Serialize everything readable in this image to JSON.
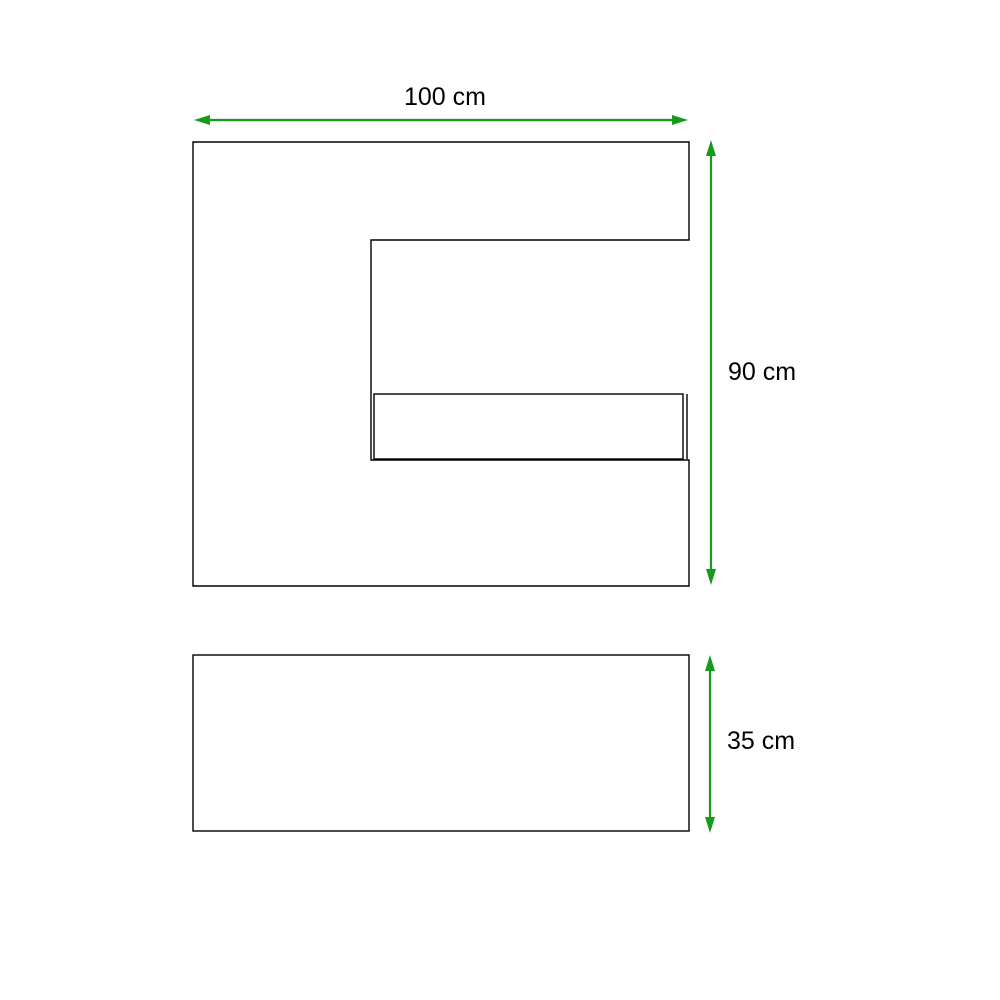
{
  "diagram": {
    "kind": "furniture-dimension-drawing",
    "unit": "cm",
    "dimensions": {
      "width": {
        "label": "100 cm",
        "value": 100,
        "orientation": "horizontal",
        "applies_to": "cabinet-front-panel"
      },
      "height": {
        "label": "90 cm",
        "value": 90,
        "orientation": "vertical",
        "applies_to": "cabinet-front-panel"
      },
      "base_height": {
        "label": "35 cm",
        "value": 35,
        "orientation": "vertical",
        "applies_to": "base-panel"
      }
    },
    "icons": {
      "dimension_arrow": "double-headed-arrow"
    },
    "colors": {
      "arrow": "#189a1a",
      "outline": "#000000",
      "text": "#000000",
      "background": "#ffffff"
    }
  }
}
